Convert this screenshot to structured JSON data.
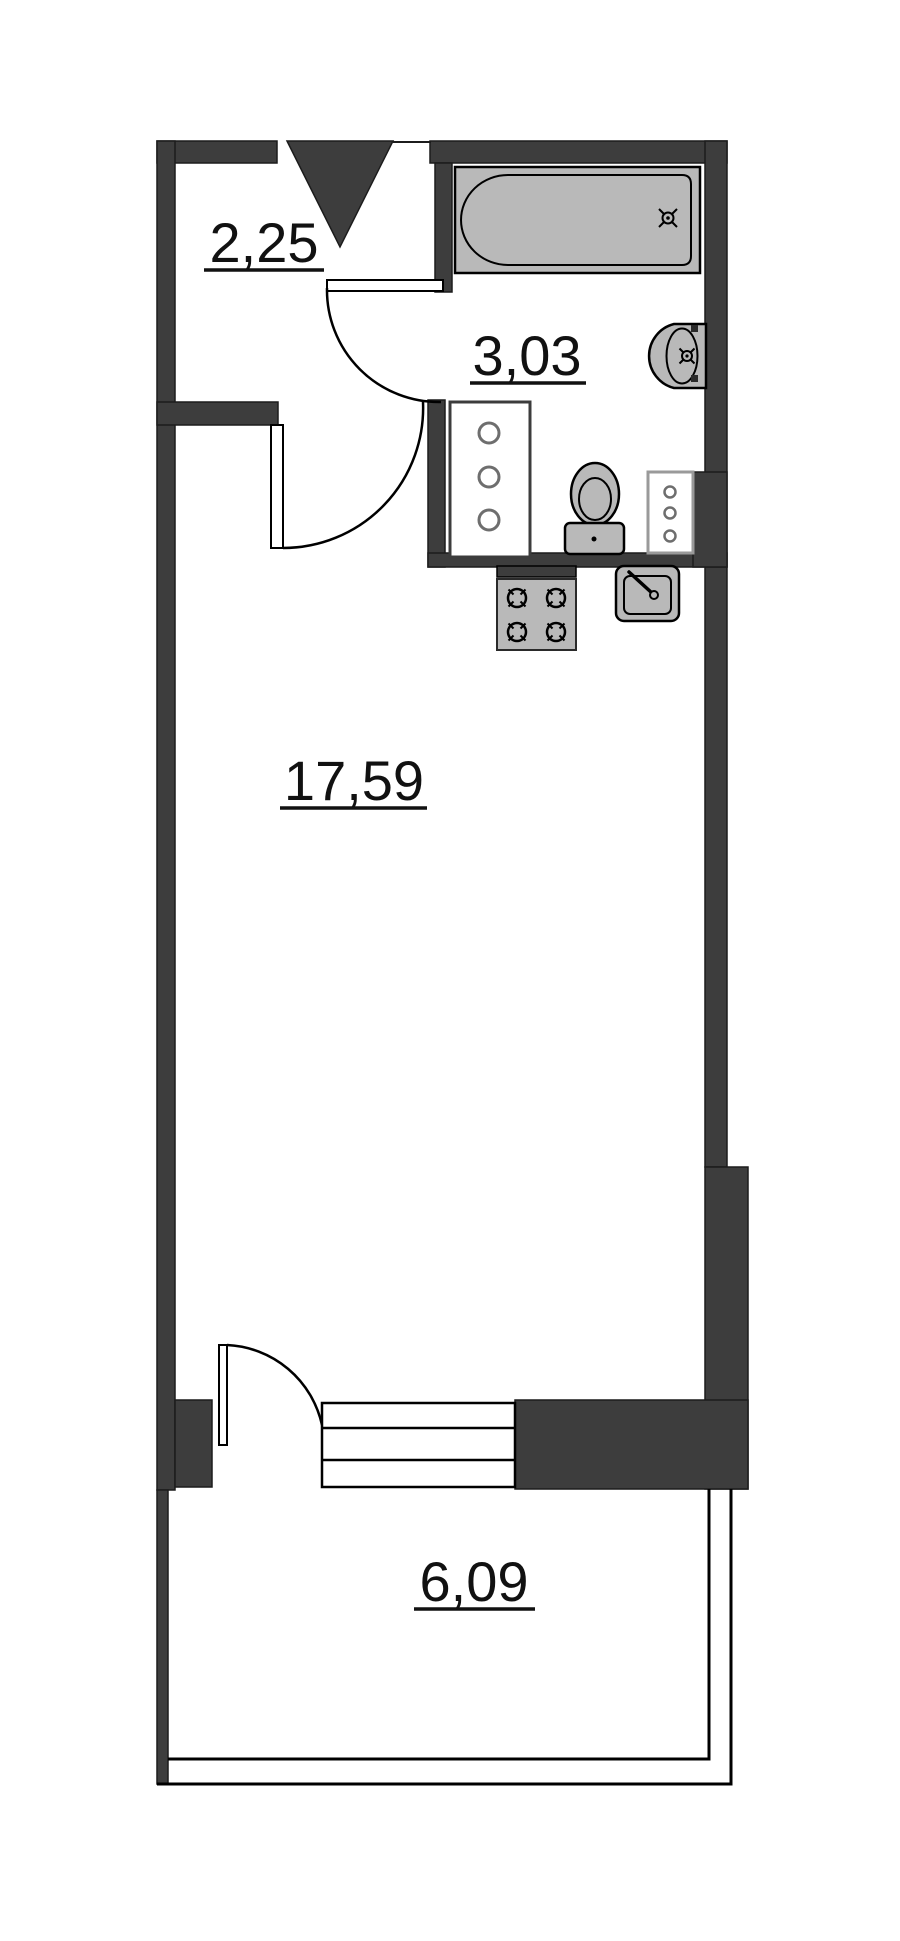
{
  "floor_plan": {
    "rooms": {
      "hallway": {
        "area": "2,25"
      },
      "bathroom": {
        "area": "3,03"
      },
      "living_room": {
        "area": "17,59"
      },
      "balcony": {
        "area": "6,09"
      }
    },
    "icons": {
      "entrance_marker": "entrance-triangle-icon",
      "bathtub": "bathtub-icon",
      "wash_basin": "wash-basin-icon",
      "toilet": "toilet-icon",
      "utility_cabinet": "utility-cabinet-icon",
      "service_cabinet": "service-cabinet-icon",
      "stove": "stove-icon",
      "kitchen_sink": "kitchen-sink-icon",
      "balcony_steps": "steps-icon",
      "door_swing": "door-swing-icon"
    },
    "colors": {
      "wall": "#3d3d3d",
      "fixture": "#b9b9b9",
      "line": "#000000",
      "text": "#111111",
      "background": "#ffffff"
    }
  }
}
